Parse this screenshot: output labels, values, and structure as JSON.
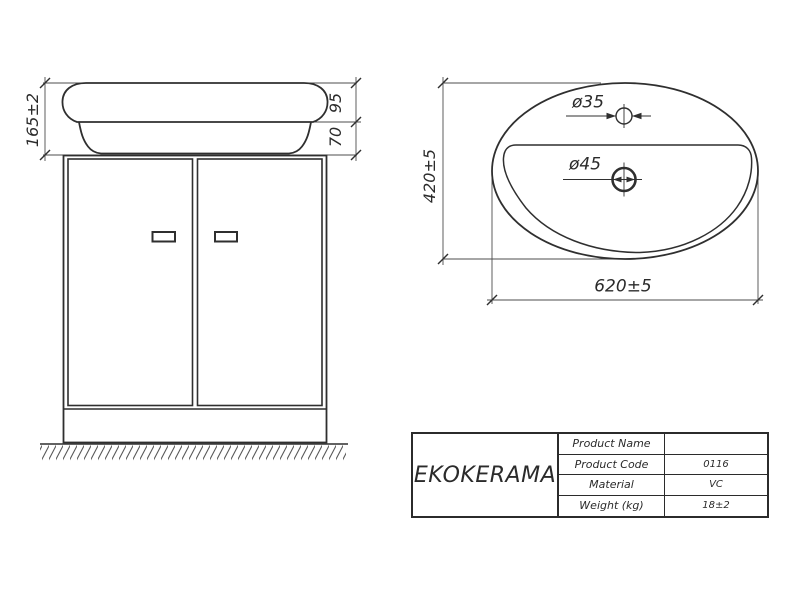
{
  "front_view": {
    "dim_total_height": "165±2",
    "dim_basin_height": "95",
    "dim_base_height": "70"
  },
  "top_view": {
    "dim_depth": "420±5",
    "dim_width": "620±5",
    "faucet_hole_dia": "ø35",
    "drain_hole_dia": "ø45"
  },
  "title_block": {
    "brand": "EKOKERAMA",
    "rows": [
      {
        "label": "Product Name",
        "value": ""
      },
      {
        "label": "Product Code",
        "value": "0116"
      },
      {
        "label": "Material",
        "value": "VC"
      },
      {
        "label": "Weight (kg)",
        "value": "18±2"
      }
    ]
  },
  "colors": {
    "line": "#2b2b2b",
    "dim_line": "#4d4d4d",
    "background": "#ffffff"
  }
}
